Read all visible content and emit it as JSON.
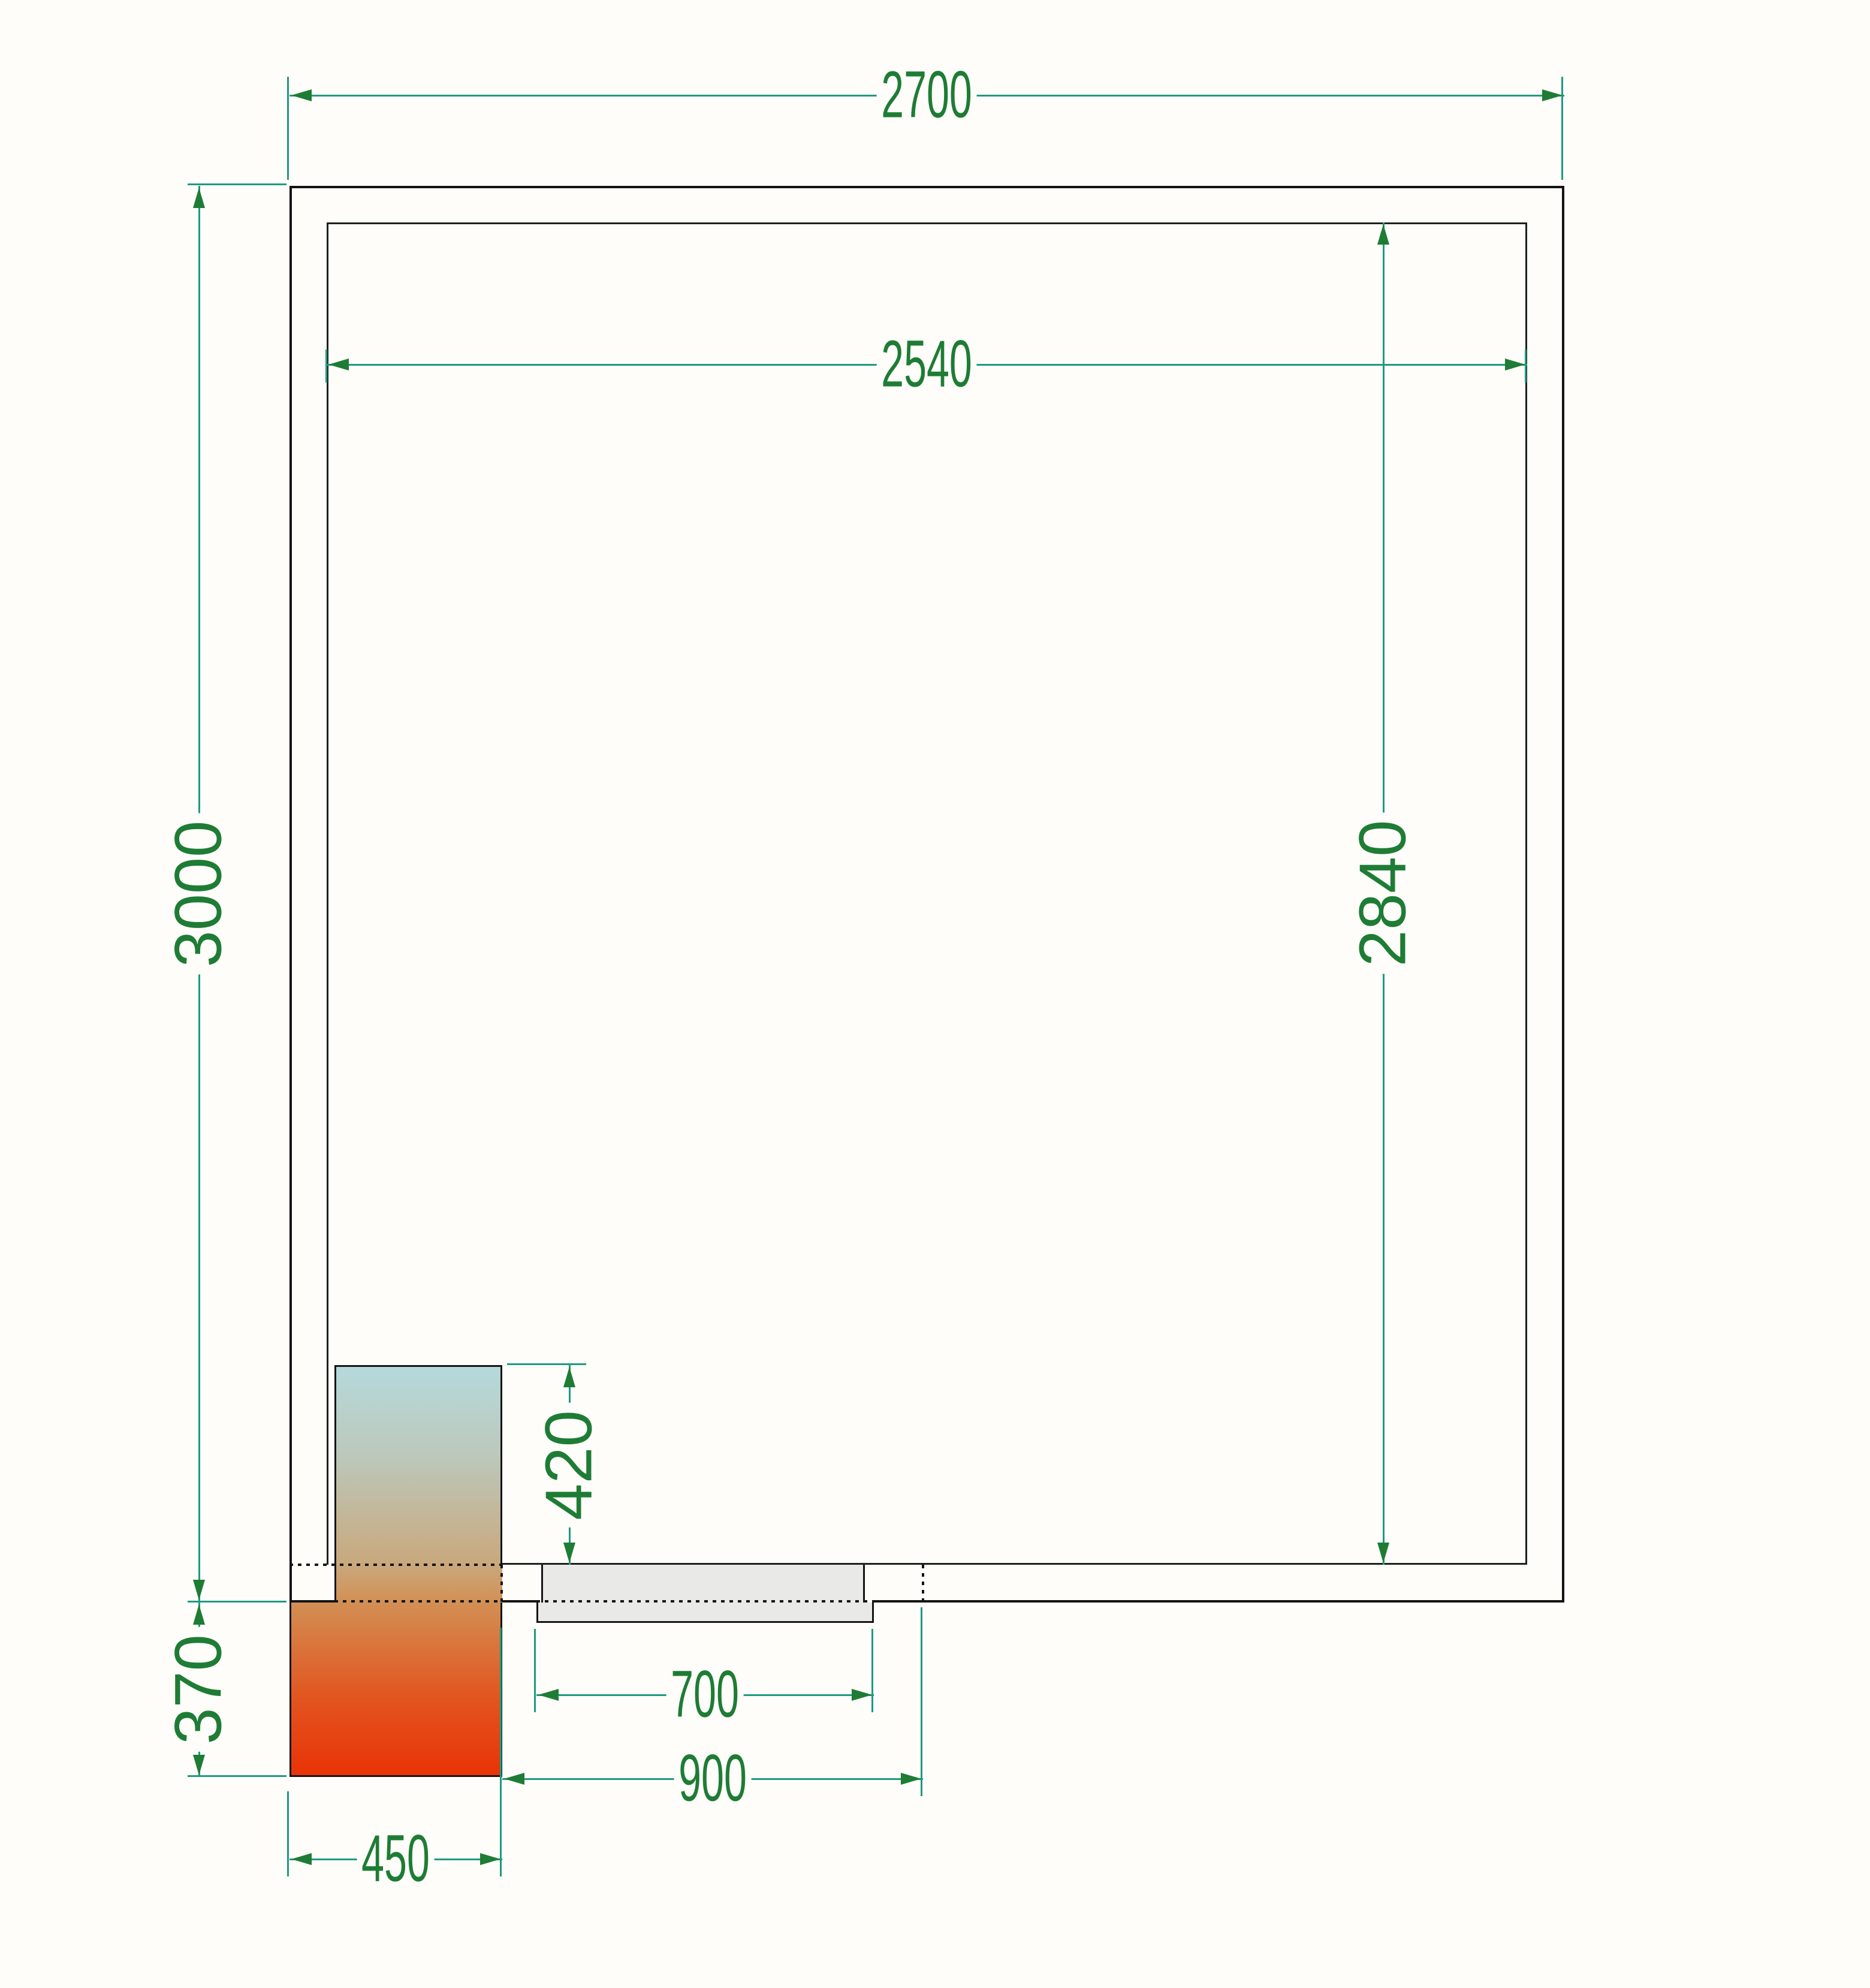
{
  "drawing": {
    "title": "cold room floor plan",
    "background_color": "#fefdf9",
    "wall_line_color": "#131313",
    "dimension_line_color": "#1f9a7f",
    "dimension_text_color": "#1e7c35",
    "door_fill_color": "#e9e9e7",
    "unit_gradient_colors": [
      "#b5d9db",
      "#c9a87c",
      "#d28f54",
      "#e93307"
    ]
  },
  "dimensions": {
    "outer_width": {
      "value": "2700",
      "orientation": "horizontal"
    },
    "inner_width": {
      "value": "2540",
      "orientation": "horizontal"
    },
    "outer_height": {
      "value": "3000",
      "orientation": "vertical"
    },
    "inner_height": {
      "value": "2840",
      "orientation": "vertical"
    },
    "unit_inside_depth": {
      "value": "420",
      "orientation": "vertical"
    },
    "unit_outside_depth": {
      "value": "370",
      "orientation": "vertical"
    },
    "door_leaf_width": {
      "value": "700",
      "orientation": "horizontal"
    },
    "door_clearance_width": {
      "value": "900",
      "orientation": "horizontal"
    },
    "unit_width": {
      "value": "450",
      "orientation": "horizontal"
    }
  }
}
